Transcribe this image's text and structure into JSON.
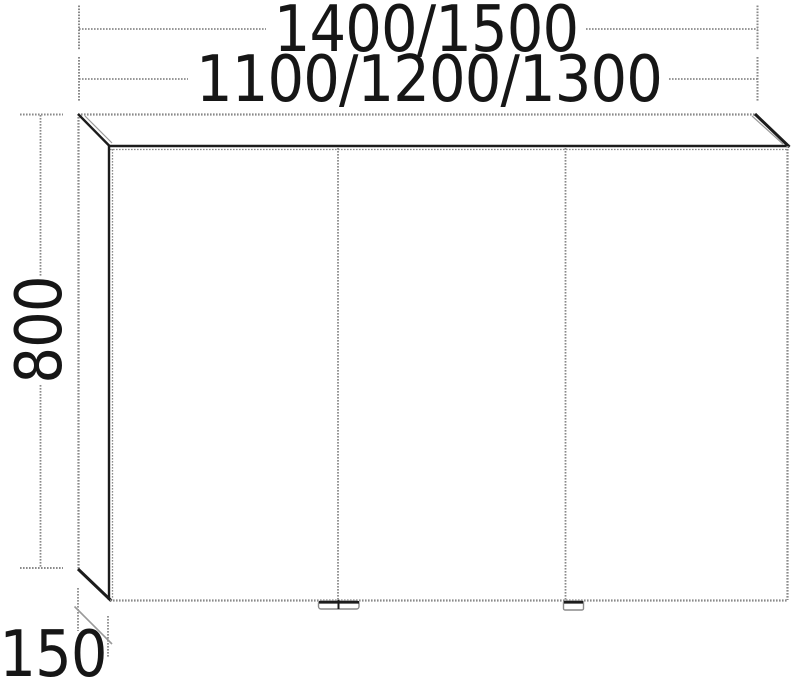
{
  "dimension_labels": {
    "overall_width": "1400/1500",
    "carcass_width": "1100/1200/1300",
    "height": "800",
    "depth": "150"
  },
  "cabinet": {
    "door_count": 3,
    "handle_count": 3
  },
  "colors": {
    "solid_line": "#1c1c1c",
    "stipple_line": "#8a8a8a",
    "text": "#161616",
    "background": "#ffffff"
  }
}
